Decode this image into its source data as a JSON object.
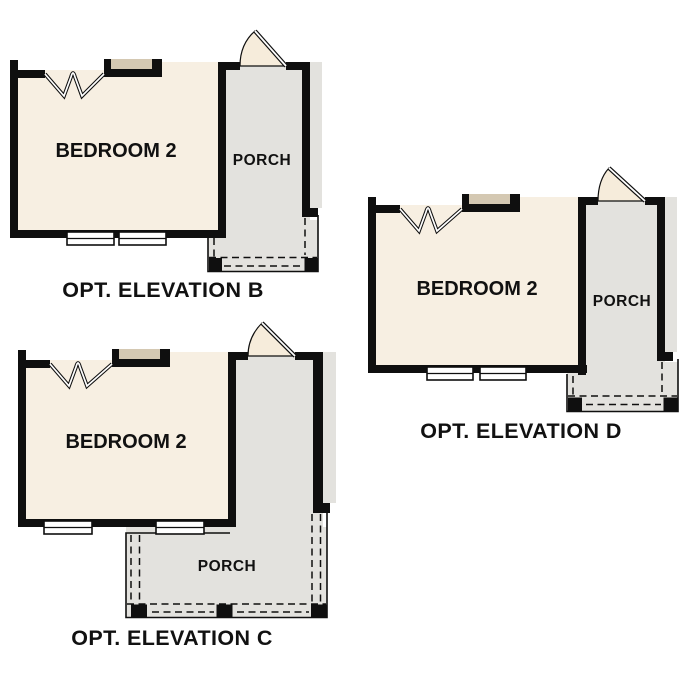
{
  "title": "Optional elevation floor plan details",
  "colors": {
    "wall": "#0f0f0f",
    "room_fill": "#f7efe2",
    "porch_fill": "#e3e2de",
    "window_tan": "#d4c8b2",
    "door_fill": "#f6ecdb",
    "background": "#ffffff",
    "text": "#111111"
  },
  "elevations": [
    {
      "id": "B",
      "room_label": "BEDROOM 2",
      "porch_label": "PORCH",
      "caption": "OPT. ELEVATION B"
    },
    {
      "id": "C",
      "room_label": "BEDROOM 2",
      "porch_label": "PORCH",
      "caption": "OPT. ELEVATION C"
    },
    {
      "id": "D",
      "room_label": "BEDROOM 2",
      "porch_label": "PORCH",
      "caption": "OPT. ELEVATION D"
    }
  ]
}
